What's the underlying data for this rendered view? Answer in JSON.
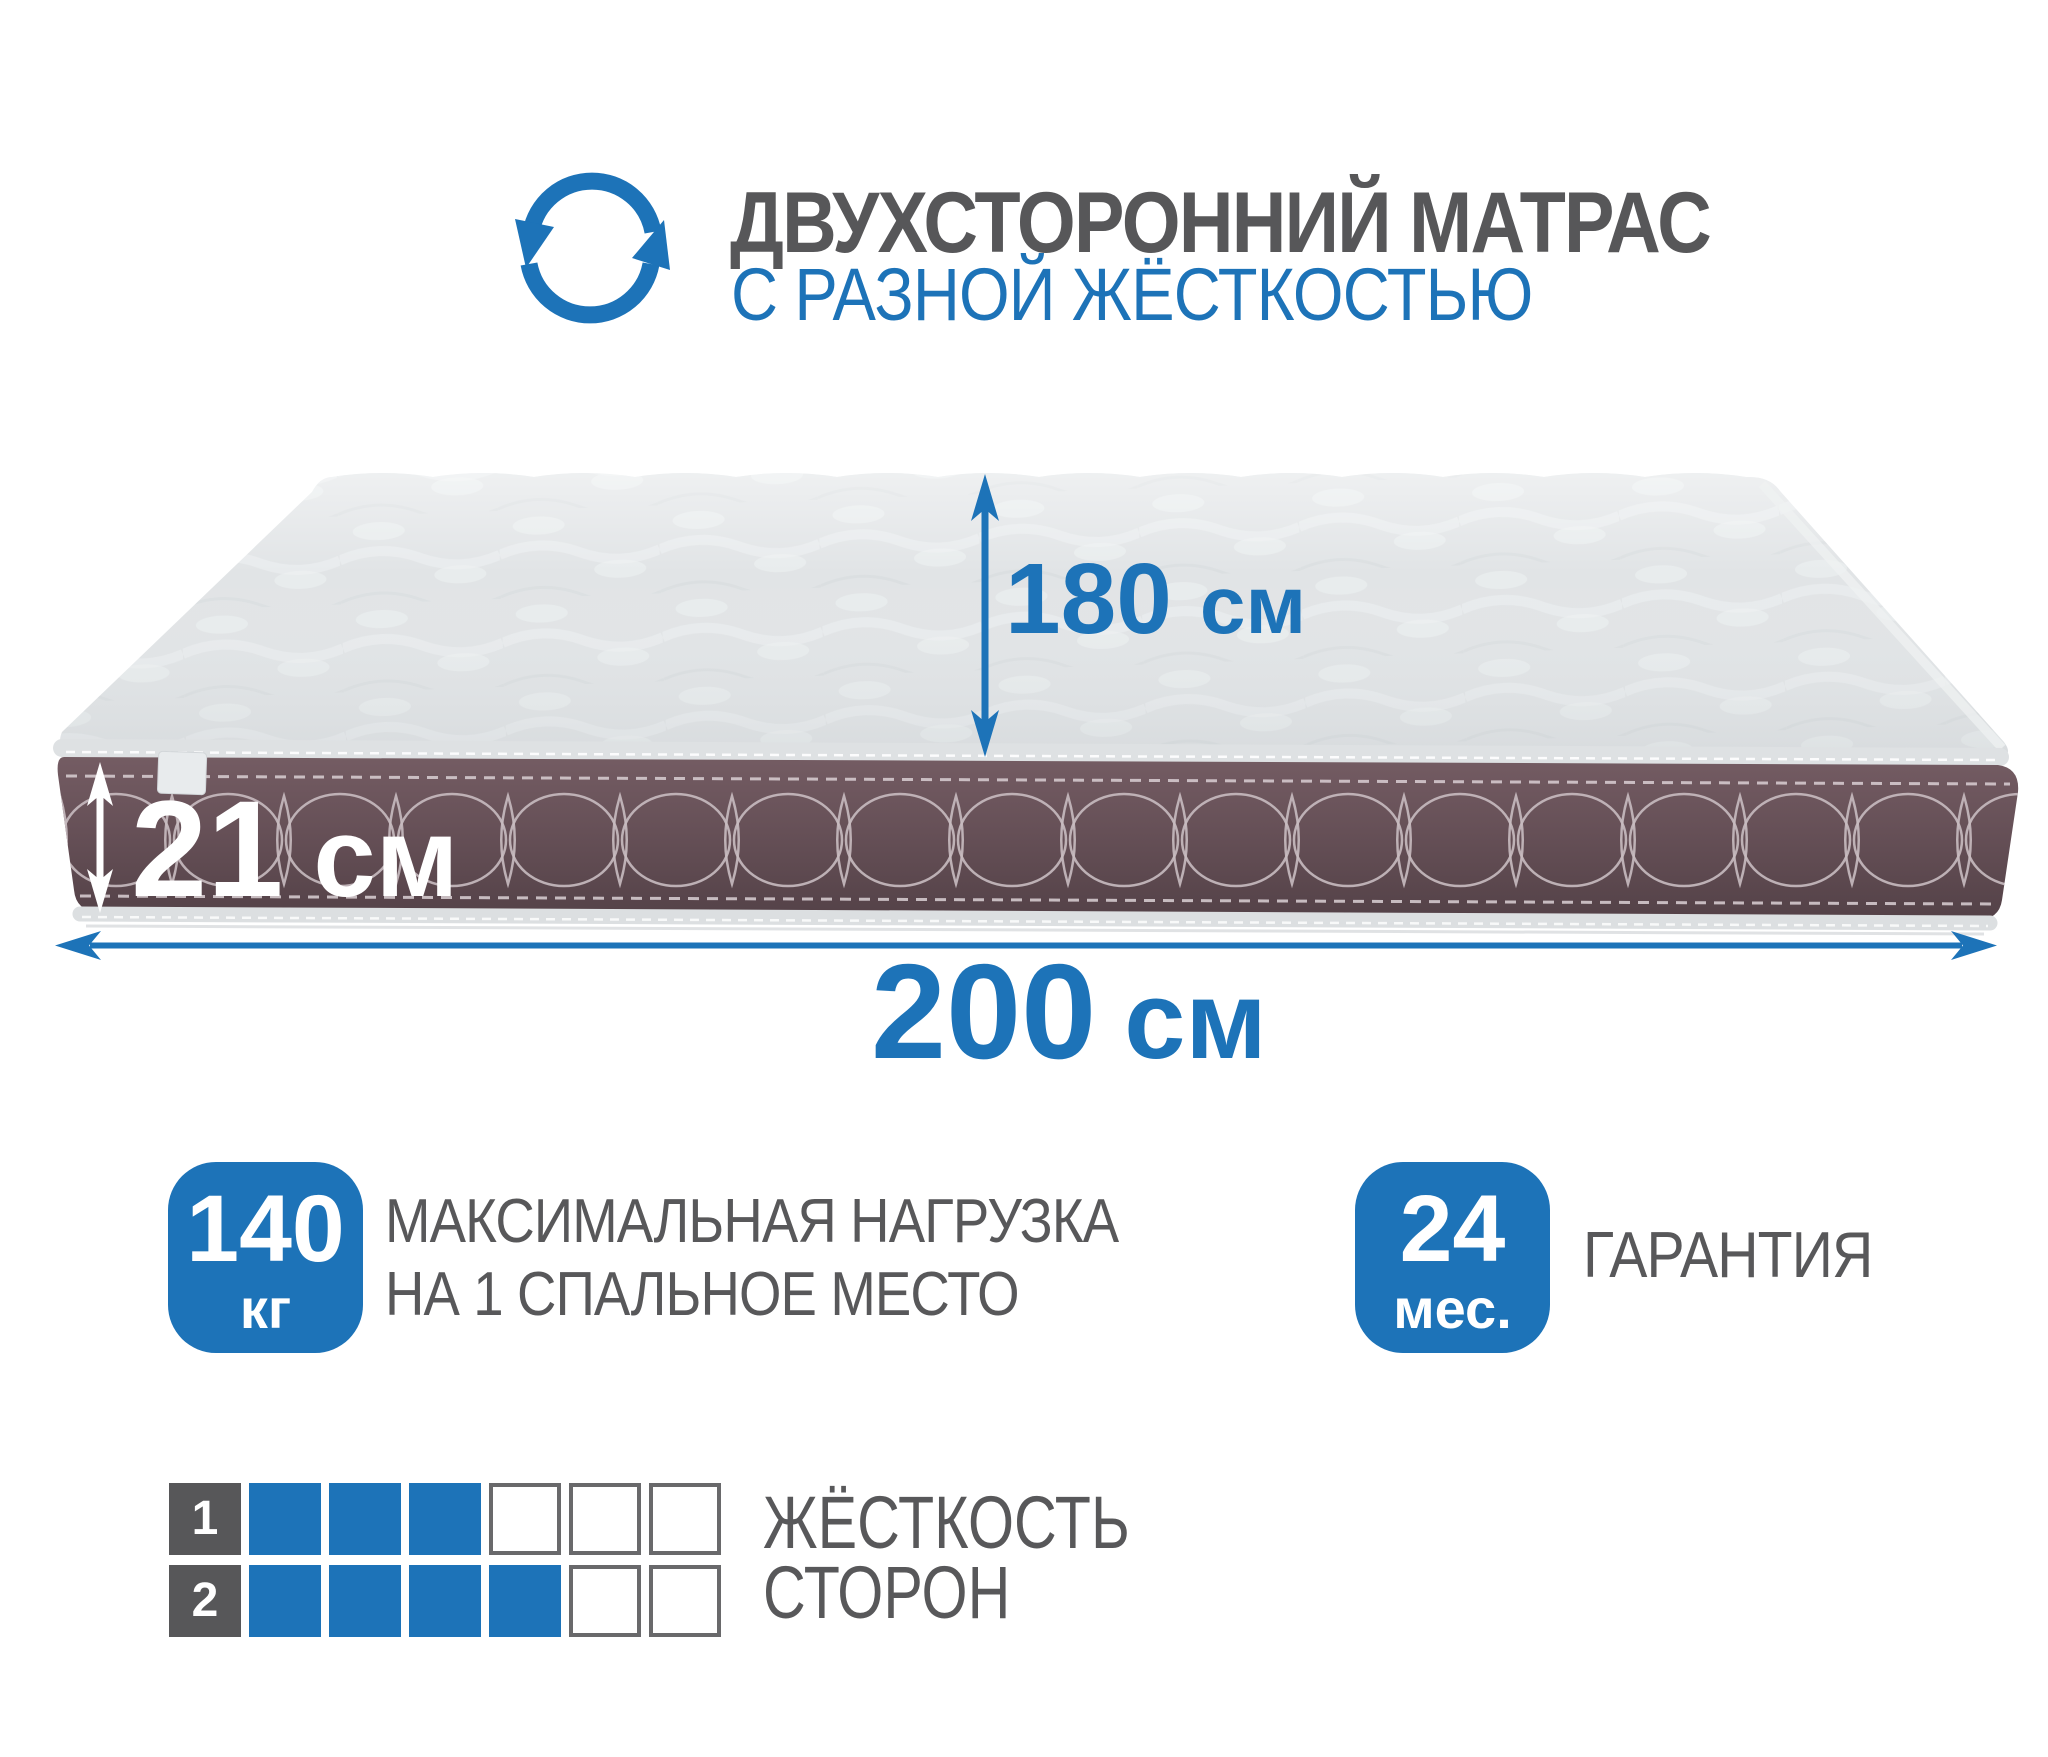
{
  "colors": {
    "accent_blue": "#1d73b8",
    "text_gray": "#58585a",
    "mattress_top_gray": "#e1e4e6",
    "mattress_band_brown": "#665057",
    "stitch_light": "#cdc2c6"
  },
  "header": {
    "icon": "flip-rotate-arrows-icon",
    "title_line1": "ДВУХСТОРОННИЙ МАТРАС",
    "title_line2": "С РАЗНОЙ ЖЁСТКОСТЬЮ"
  },
  "dimensions": {
    "depth": {
      "value": "180",
      "unit": "см"
    },
    "thickness": {
      "value": "21",
      "unit": "см"
    },
    "length": {
      "value": "200",
      "unit": "см"
    }
  },
  "badges": {
    "max_load": {
      "value": "140",
      "unit": "кг",
      "label_line1": "МАКСИМАЛЬНАЯ НАГРУЗКА",
      "label_line2": "НА 1 СПАЛЬНОЕ МЕСТО"
    },
    "warranty": {
      "value": "24",
      "unit": "мес.",
      "label": "ГАРАНТИЯ"
    }
  },
  "firmness": {
    "label_line1": "ЖЁСТКОСТЬ",
    "label_line2": "СТОРОН",
    "scale_max": 6,
    "rows": [
      {
        "side": "1",
        "filled": 3
      },
      {
        "side": "2",
        "filled": 4
      }
    ]
  }
}
